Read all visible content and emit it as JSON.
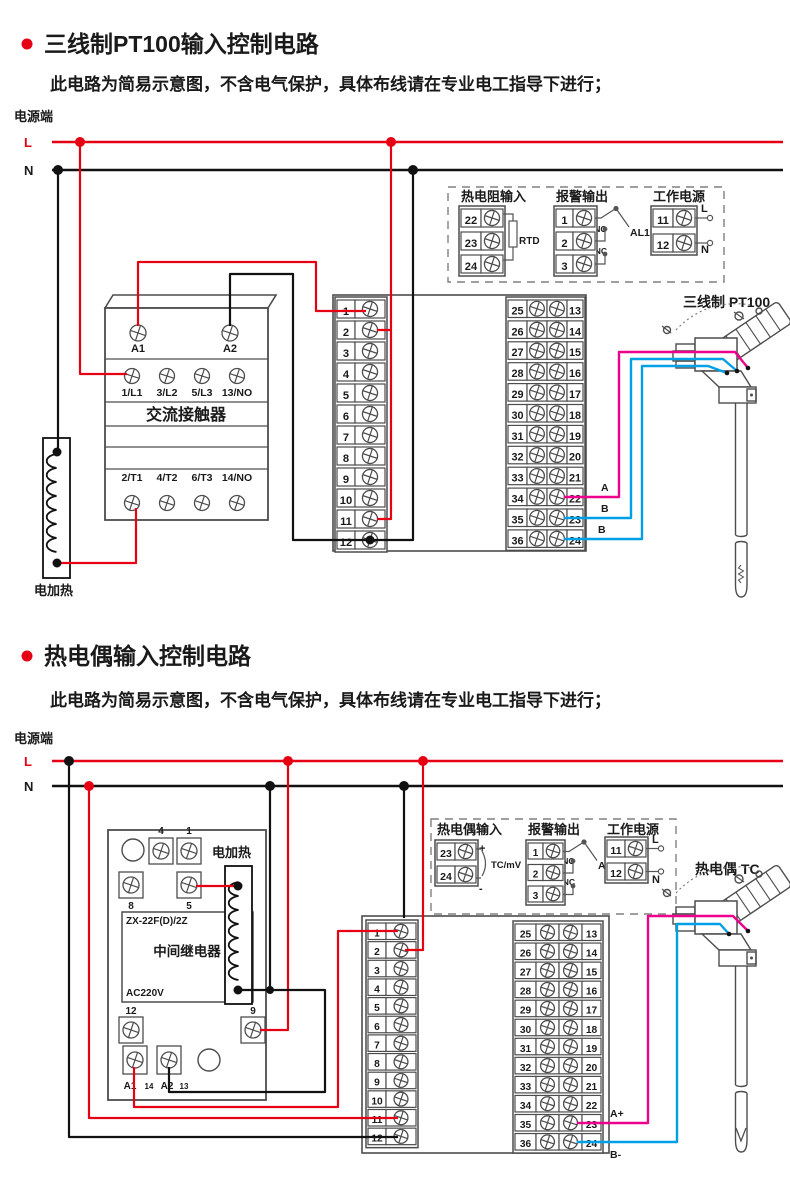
{
  "colors": {
    "red": "#e60013",
    "black": "#111111",
    "magenta": "#ec008c",
    "cyan": "#00a0e6",
    "outline": "#4d4d4d",
    "bullet": "#e60013"
  },
  "sections": [
    {
      "title": "三线制PT100输入控制电路",
      "subtitle": "此电路为简易示意图，不含电气保护，具体布线请在专业电工指导下进行；",
      "power_label": "电源端",
      "l": "L",
      "n": "N",
      "heater": "电加热",
      "contactor": {
        "a1": "A1",
        "a2": "A2",
        "row1": [
          "1/L1",
          "3/L2",
          "5/L3",
          "13/NO"
        ],
        "name": "交流接触器",
        "row2": [
          "2/T1",
          "4/T2",
          "6/T3",
          "14/NO"
        ]
      },
      "strip_left": [
        "1",
        "2",
        "3",
        "4",
        "5",
        "6",
        "7",
        "8",
        "9",
        "10",
        "11",
        "12"
      ],
      "strip_right": {
        "left": [
          "25",
          "26",
          "27",
          "28",
          "29",
          "30",
          "31",
          "32",
          "33",
          "34",
          "35",
          "36"
        ],
        "right": [
          "13",
          "14",
          "15",
          "16",
          "17",
          "18",
          "19",
          "20",
          "21",
          "22",
          "23",
          "24"
        ]
      },
      "legend": {
        "input": {
          "title": "热电阻输入",
          "terminals": [
            "22",
            "23",
            "24"
          ],
          "device": "RTD"
        },
        "alarm": {
          "title": "报警输出",
          "terminals": [
            "1",
            "2",
            "3"
          ],
          "no": "NO",
          "nc": "NC",
          "name": "AL1"
        },
        "power": {
          "title": "工作电源",
          "terminals": [
            "11",
            "12"
          ],
          "l": "L",
          "n": "N"
        }
      },
      "sensor": {
        "label": "三线制 PT100",
        "wires": [
          "A",
          "B",
          "B"
        ]
      }
    },
    {
      "title": "热电偶输入控制电路",
      "subtitle": "此电路为简易示意图，不含电气保护，具体布线请在专业电工指导下进行；",
      "power_label": "电源端",
      "l": "L",
      "n": "N",
      "heater": "电加热",
      "relay": {
        "model": "ZX-22F(D)/2Z",
        "name": "中间继电器",
        "voltage": "AC220V",
        "t_top": [
          "4",
          "1"
        ],
        "t_mid": [
          "8",
          "5"
        ],
        "t_low": [
          "12",
          "9"
        ],
        "t_bottom": [
          "A1",
          "14",
          "A2",
          "13"
        ]
      },
      "strip_left": [
        "1",
        "2",
        "3",
        "4",
        "5",
        "6",
        "7",
        "8",
        "9",
        "10",
        "11",
        "12"
      ],
      "strip_right": {
        "left": [
          "25",
          "26",
          "27",
          "28",
          "29",
          "30",
          "31",
          "32",
          "33",
          "34",
          "35",
          "36"
        ],
        "right": [
          "13",
          "14",
          "15",
          "16",
          "17",
          "18",
          "19",
          "20",
          "21",
          "22",
          "23",
          "24"
        ]
      },
      "legend": {
        "input": {
          "title": "热电偶输入",
          "terminals": [
            "23",
            "24"
          ],
          "plus": "+",
          "minus": "-",
          "device": "TC/mV"
        },
        "alarm": {
          "title": "报警输出",
          "terminals": [
            "1",
            "2",
            "3"
          ],
          "no": "NO",
          "nc": "NC",
          "name": "AL1"
        },
        "power": {
          "title": "工作电源",
          "terminals": [
            "11",
            "12"
          ],
          "l": "L",
          "n": "N"
        }
      },
      "sensor": {
        "label": "热电偶 TC",
        "wires": [
          "A+",
          "B-"
        ]
      }
    }
  ]
}
